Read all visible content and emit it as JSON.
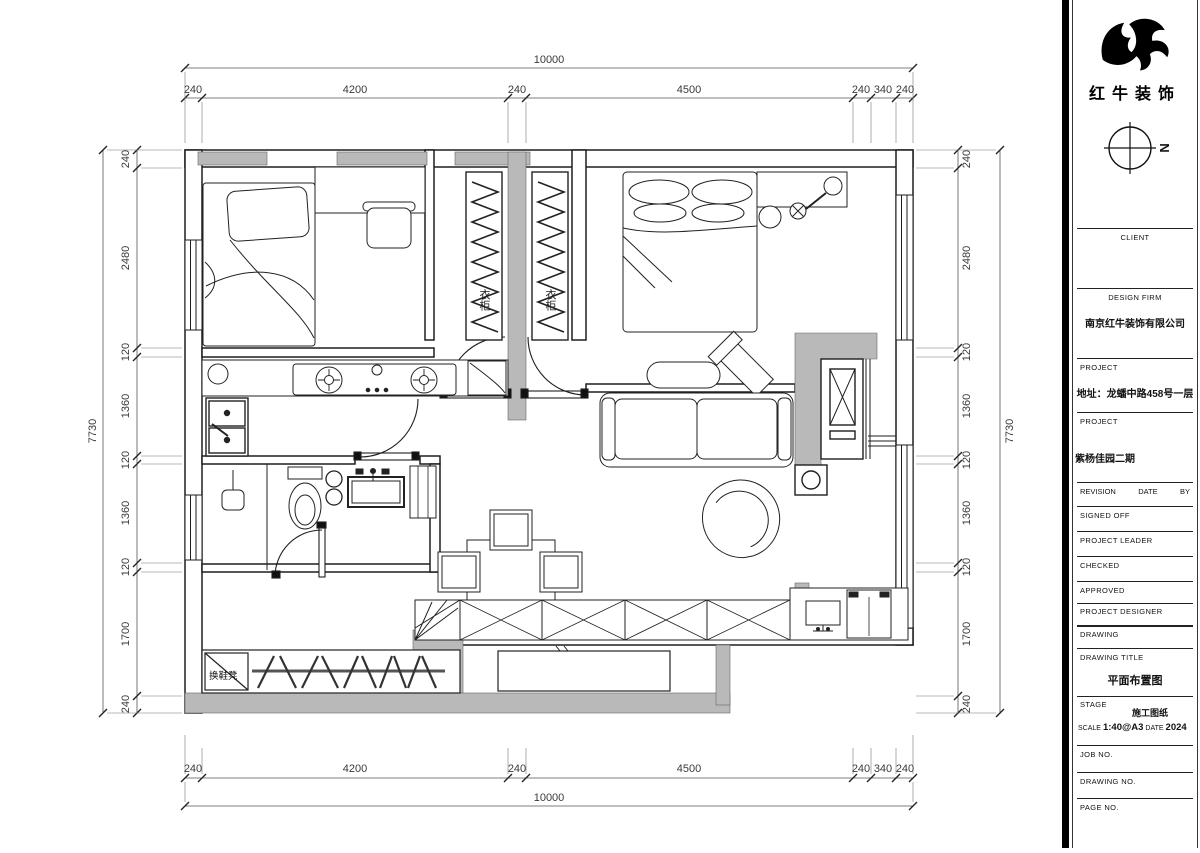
{
  "title_block": {
    "company_name": "红牛装饰",
    "north_letter": "N",
    "client_label": "CLIENT",
    "design_firm_label": "DESIGN FIRM",
    "design_firm_value": "南京红牛装饰有限公司",
    "project_label_1": "PROJECT",
    "project_address": "地址：龙蟠中路458号一层",
    "project_label_2": "PROJECT",
    "project_name": "紫杨佳园二期",
    "revision_label": "REVISION",
    "date_label": "DATE",
    "by_label": "BY",
    "signed_off_label": "SIGNED OFF",
    "project_leader_label": "PROJECT LEADER",
    "checked_label": "CHECKED",
    "approved_label": "APPROVED",
    "project_designer_label": "PROJECT DESIGNER",
    "drawing_label": "DRAWING",
    "drawing_title_label": "DRAWING TITLE",
    "drawing_title_value": "平面布置图",
    "stage_label": "STAGE",
    "stage_value": "施工图纸",
    "scale_label": "SCALE",
    "scale_value": "1:40@A3",
    "date_label2": "DATE",
    "date_value": "2024",
    "job_no_label": "JOB NO.",
    "drawing_no_label": "DRAWING NO.",
    "page_no_label": "PAGE NO."
  },
  "plan": {
    "labels": {
      "wardrobe_left": "衣柜",
      "wardrobe_right": "衣柜",
      "shoe_bench": "换鞋凳"
    },
    "dimensions": {
      "top": {
        "overall": "10000",
        "segments": [
          "240",
          "4200",
          "240",
          "4500",
          "240",
          "340",
          "240"
        ]
      },
      "bottom": {
        "overall": "10000",
        "segments": [
          "240",
          "4200",
          "240",
          "4500",
          "240",
          "340",
          "240"
        ]
      },
      "left": {
        "overall": "7730",
        "segments": [
          "240",
          "2480",
          "120",
          "1360",
          "120",
          "1360",
          "120",
          "1700",
          "240"
        ]
      },
      "right": {
        "overall": "7730",
        "segments": [
          "240",
          "2480",
          "120",
          "1360",
          "120",
          "1360",
          "120",
          "1700",
          "240"
        ]
      }
    },
    "colors": {
      "wall_fill": "#b9b9b9",
      "line": "#2a2a2a"
    }
  }
}
